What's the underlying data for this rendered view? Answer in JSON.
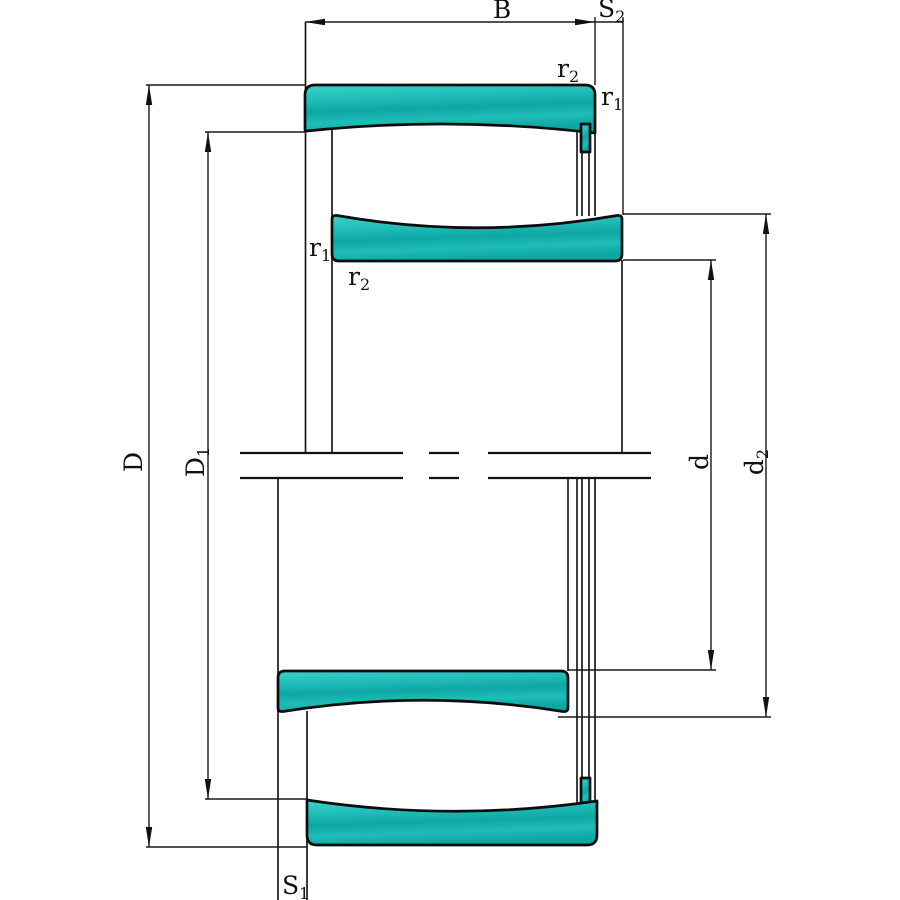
{
  "drawing": {
    "labels": {
      "B": {
        "main": "B",
        "sub": ""
      },
      "S2": {
        "main": "S",
        "sub": "2"
      },
      "r2_outer": {
        "main": "r",
        "sub": "2"
      },
      "r1_outer": {
        "main": "r",
        "sub": "1"
      },
      "r1_inner": {
        "main": "r",
        "sub": "1"
      },
      "r2_inner": {
        "main": "r",
        "sub": "2"
      },
      "D": {
        "main": "D",
        "sub": ""
      },
      "D1": {
        "main": "D",
        "sub": "1"
      },
      "d": {
        "main": "d",
        "sub": ""
      },
      "d2": {
        "main": "d",
        "sub": "2"
      },
      "S1": {
        "main": "S",
        "sub": "1"
      }
    },
    "colors": {
      "fill_light": "#3bd0ca",
      "fill_base": "#1fbdb8",
      "fill_dark": "#0fa6a3",
      "outline": "#0d0d0d",
      "line_color": "#1a1a1a",
      "background": "#ffffff"
    }
  }
}
